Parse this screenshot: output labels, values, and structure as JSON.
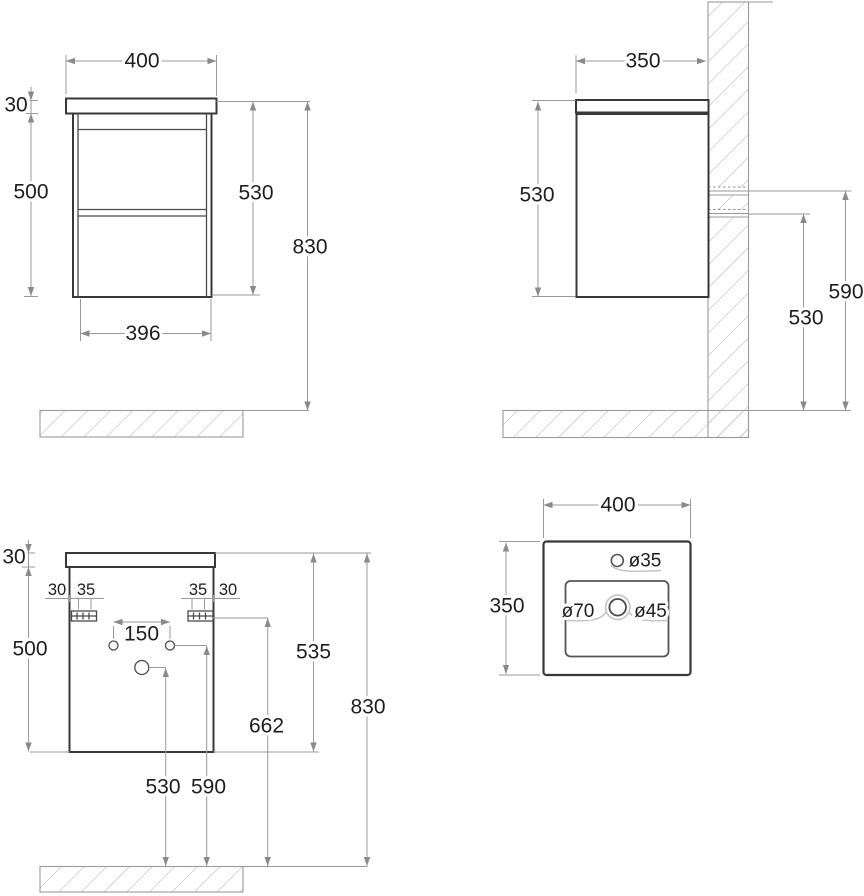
{
  "document": {
    "type": "technical drawing",
    "subject": "wall-hung vanity cabinet with basin, dimensioned views",
    "units": "mm"
  },
  "colors": {
    "background": "#ffffff",
    "object_line": "#383838",
    "dimension_line": "#9a9a9a",
    "text": "#1d1d1d",
    "hatch_line": "#b8b8b8",
    "leader_line": "#c4c4c4"
  },
  "front_view": {
    "name": "front view",
    "dim_width_top": "400",
    "dim_panel_thickness": "30",
    "dim_body_height": "500",
    "dim_height_to_body_bottom": "530",
    "dim_total_height": "830",
    "dim_width_bottom": "396"
  },
  "side_view": {
    "name": "side view",
    "dim_depth": "350",
    "dim_cabinet_height": "530",
    "dim_upper_rail_height": "590",
    "dim_lower_rail_height": "530"
  },
  "rear_view": {
    "name": "rear mounting view",
    "dim_panel_thickness": "30",
    "dim_body_height": "500",
    "dim_edge_offset_left": "30",
    "dim_hole_offset_left": "35",
    "dim_hole_offset_right": "35",
    "dim_edge_offset_right": "30",
    "dim_hole_spacing": "150",
    "dim_panel_top_to_body_bottom": "535",
    "dim_bracket_height": "662",
    "dim_total_height": "830",
    "dim_drain_height": "530",
    "dim_supply_height": "590"
  },
  "basin_view": {
    "name": "basin top view",
    "dim_width": "400",
    "dim_depth": "350",
    "label_faucet_hole": "ø35",
    "label_overflow": "ø70",
    "label_drain": "ø45"
  }
}
